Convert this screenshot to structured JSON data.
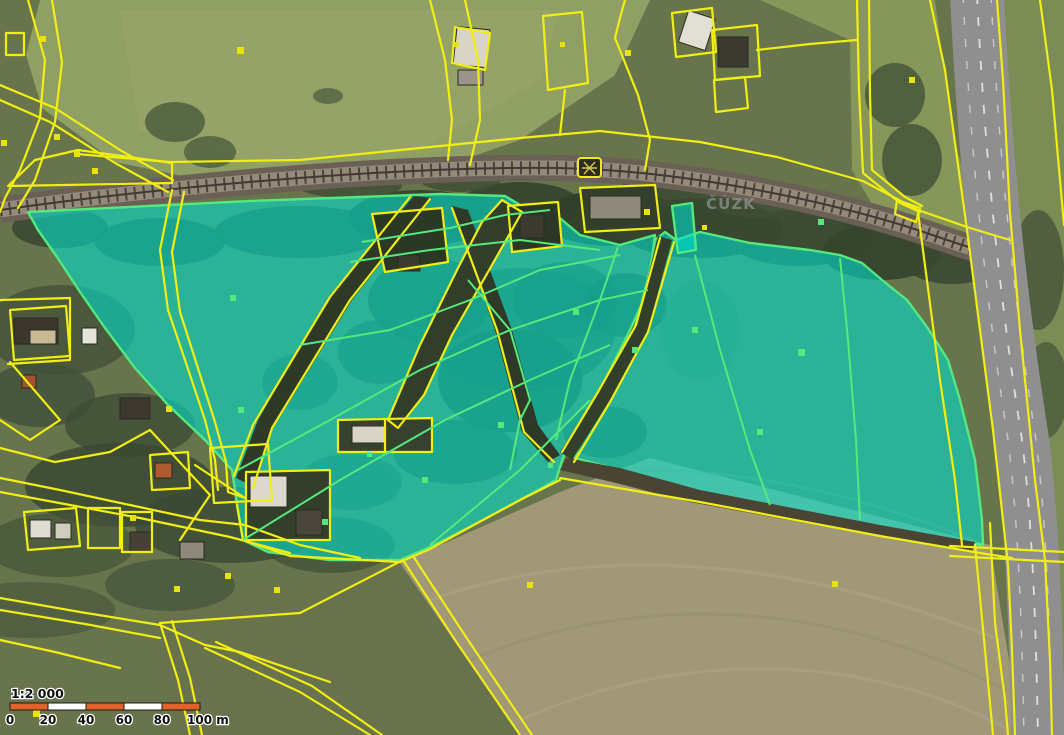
{
  "map": {
    "watermark": "ČÚZK",
    "scalebar": {
      "ratio_label": "1:2 000",
      "ticks": [
        "0",
        "20",
        "40",
        "60",
        "80",
        "100 m"
      ],
      "segment_count": 5,
      "primary_color": "#e2622b",
      "secondary_color": "#ffffff",
      "outline_color": "#1a1a1a",
      "text_color": "#111111"
    },
    "colors": {
      "parcel_line": "#f0ee12",
      "highlight_fill": "#00e2cf",
      "highlight_stroke": "#55e87d",
      "marker_yellow": "#e8e20e",
      "marker_green": "#55e87d",
      "watermark_gray": "#8e9696",
      "railway_bed": "#958a7a",
      "asphalt": "#8f8f8f"
    },
    "legend": {
      "selected_parcels": "highlighted cadastral parcels (cyan)",
      "parcel_boundaries": "cadastral parcel boundaries (yellow)",
      "railway": "railway corridor",
      "highway": "paved road"
    }
  }
}
